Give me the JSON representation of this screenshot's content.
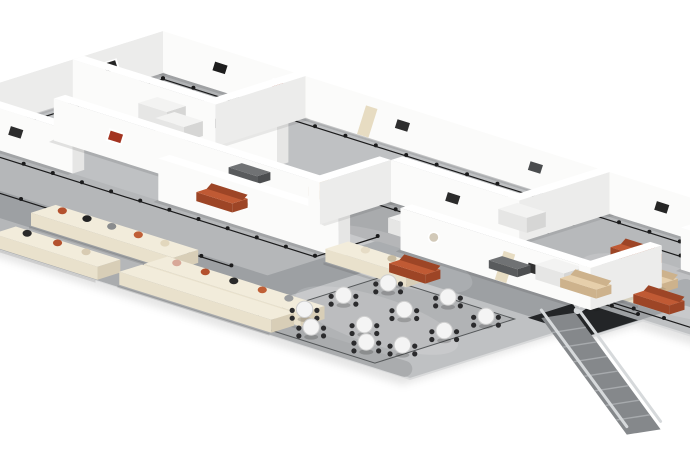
{
  "scene": {
    "description": "isometric-museum-floorplan-render",
    "width": 690,
    "height": 460
  },
  "projection": {
    "ox": 163,
    "oy": 73,
    "kx": 0.95,
    "ky": 0.3,
    "wall_height": 42,
    "wall_thickness": 12
  },
  "palette": {
    "background": "#ffffff",
    "floor_base": "#bfc1c3",
    "floor_edge": "#d9dadb",
    "shadow": "rgba(0,0,0,0.10)",
    "wall_front": "#fbfbfa",
    "wall_top": "#ffffff",
    "wall_side": "#ececeb",
    "wall_cap": "#e6e6e5",
    "track": "#1b1b1c",
    "path_dark": "#9da0a3",
    "edge_band": "#aaacae",
    "hole": "#232527",
    "escalator_rail": "#d6d9db",
    "escalator_band": "#85888b",
    "escalator_tread": "#a7aaad",
    "plinth_top": "#f2ecdb",
    "plinth_front": "#e9e1cc",
    "plinth_side": "#d8ceb7",
    "pedestal_top": "#f3f3f2",
    "pedestal_front": "#e6e6e5",
    "pedestal_side": "#d6d6d5",
    "bench_top": "#707274",
    "bench_front": "#595b5d",
    "sofa_terracotta_top": "#c05a34",
    "sofa_terracotta_front": "#9d4526",
    "sofa_beige_top": "#e6cfab",
    "sofa_beige_front": "#cdb28c",
    "table_top": "#f4f4f4",
    "table_rim": "#cfcfcf",
    "chair": "#2b2b2d",
    "door": "#e7dcc2",
    "art_frame": "#ffffff"
  },
  "floor": {
    "footprint": [
      [
        0,
        0
      ],
      [
        950,
        0
      ],
      [
        950,
        160
      ],
      [
        665,
        160
      ],
      [
        665,
        218
      ],
      [
        640,
        218
      ],
      [
        640,
        380
      ],
      [
        0,
        380
      ]
    ],
    "zones": [
      {
        "name": "gallery-a",
        "rect": [
          0,
          0,
          150,
          95
        ],
        "fill": "#b2b4b6"
      },
      {
        "name": "gallery-center-dark",
        "rect": [
          335,
          95,
          285,
          75
        ],
        "fill": "#a9abad"
      },
      {
        "name": "gallery-topright",
        "rect": [
          470,
          0,
          150,
          95
        ],
        "fill": "#b7b9bb"
      },
      {
        "name": "plinth-hall",
        "rect": [
          0,
          215,
          400,
          165
        ],
        "fill": "#b5b7b9"
      },
      {
        "name": "cafe-floor",
        "rect": [
          455,
          225,
          140,
          147
        ],
        "fill": "#b1b3b5"
      }
    ],
    "visitor_path": {
      "points": [
        [
          0,
          305
        ],
        [
          415,
          305
        ],
        [
          415,
          190
        ],
        [
          640,
          190
        ],
        [
          640,
          90
        ],
        [
          770,
          90
        ]
      ],
      "width": 26
    },
    "edge_band": {
      "points": [
        [
          150,
          366
        ],
        [
          620,
          366
        ]
      ],
      "width": 16
    }
  },
  "tracks": [
    {
      "points": [
        [
          12,
          12
        ],
        [
          940,
          12
        ]
      ]
    },
    {
      "points": [
        [
          12,
          12
        ],
        [
          12,
          368
        ]
      ]
    },
    {
      "points": [
        [
          12,
          82
        ],
        [
          136,
          82
        ]
      ]
    },
    {
      "points": [
        [
          26,
          158
        ],
        [
          322,
          158
        ]
      ]
    },
    {
      "points": [
        [
          322,
          158
        ],
        [
          322,
          108
        ],
        [
          600,
          108
        ],
        [
          600,
          155
        ],
        [
          655,
          155
        ]
      ]
    },
    {
      "points": [
        [
          20,
          228
        ],
        [
          388,
          228
        ],
        [
          388,
          162
        ]
      ]
    },
    {
      "points": [
        [
          12,
          288
        ],
        [
          360,
          288
        ]
      ]
    },
    {
      "points": [
        [
          930,
          35
        ],
        [
          548,
          35
        ],
        [
          548,
          148
        ],
        [
          930,
          148
        ]
      ]
    },
    {
      "points": [
        [
          470,
          12
        ],
        [
          470,
          92
        ]
      ]
    }
  ],
  "cafe": {
    "outline_rect": [
      455,
      225,
      140,
      147
    ],
    "tables": [
      [
        485,
        248
      ],
      [
        540,
        240
      ],
      [
        592,
        252
      ],
      [
        482,
        292
      ],
      [
        538,
        284
      ],
      [
        594,
        298
      ],
      [
        485,
        336
      ],
      [
        542,
        330
      ],
      [
        596,
        344
      ],
      [
        518,
        362
      ],
      [
        572,
        358
      ]
    ],
    "chair_offsets": [
      [
        13,
        0
      ],
      [
        -13,
        0
      ],
      [
        0,
        13
      ],
      [
        0,
        -13
      ]
    ]
  },
  "hole": [
    [
      600,
      162
    ],
    [
      662,
      162
    ],
    [
      662,
      216
    ],
    [
      600,
      216
    ]
  ],
  "escalator": {
    "from": [
      612,
      196
    ],
    "to": [
      748,
      242
    ],
    "width": 28,
    "drop": 62,
    "treads": 7,
    "approach": [
      [
        588,
        128
      ],
      [
        604,
        152
      ],
      [
        614,
        178
      ]
    ]
  },
  "walls": [
    {
      "axis": "u",
      "at": 0,
      "from": 0,
      "to": 950,
      "name": "perimeter-ne",
      "art": [
        {
          "u": 60,
          "c": "#1d1d1d"
        },
        {
          "u": 122,
          "c": "#b23a20",
          "framed": true
        },
        {
          "u": 252,
          "c": "#2e2e2e"
        },
        {
          "u": 392,
          "c": "#4a4c4e"
        },
        {
          "u": 525,
          "c": "#262626"
        },
        {
          "u": 615,
          "circle": "#cabfa9"
        },
        {
          "u": 762,
          "c": "#303032"
        },
        {
          "u": 885,
          "c": "#ad4a2c"
        }
      ],
      "doors": [
        215,
        705
      ]
    },
    {
      "axis": "v",
      "at": 0,
      "from": 0,
      "to": 380,
      "name": "perimeter-nw",
      "art": [
        {
          "v": 55,
          "c": "#242424",
          "framed": true
        },
        {
          "v": 250,
          "c": "#2a2a2a"
        }
      ],
      "doors": []
    },
    {
      "axis": "v",
      "at": 150,
      "from": 0,
      "to": 95,
      "name": "partition",
      "art": [],
      "doors": []
    },
    {
      "axis": "u",
      "at": 95,
      "from": 0,
      "to": 215,
      "name": "partition",
      "art": [
        {
          "u": 150,
          "c": "#333335"
        }
      ],
      "doors": []
    },
    {
      "axis": "u",
      "at": 170,
      "from": 55,
      "to": 335,
      "name": "partition",
      "art": [
        {
          "u": 120,
          "c": "#a33420",
          "framed": true
        },
        {
          "u": 250,
          "circle": "#cfc6b4"
        }
      ],
      "doors": []
    },
    {
      "axis": "v",
      "at": 335,
      "from": 95,
      "to": 170,
      "name": "partition",
      "art": [],
      "doors": []
    },
    {
      "axis": "u",
      "at": 95,
      "from": 335,
      "to": 470,
      "name": "partition",
      "art": [
        {
          "u": 400,
          "c": "#2b2b2b"
        }
      ],
      "doors": []
    },
    {
      "axis": "v",
      "at": 470,
      "from": 0,
      "to": 95,
      "name": "partition",
      "art": [],
      "doors": []
    },
    {
      "axis": "u",
      "at": 170,
      "from": 420,
      "to": 620,
      "name": "partition",
      "art": [
        {
          "u": 455,
          "circle": "#d2c9b8"
        },
        {
          "u": 560,
          "c": "#303030"
        }
      ],
      "doors": [
        530
      ]
    },
    {
      "axis": "v",
      "at": 620,
      "from": 95,
      "to": 170,
      "name": "partition",
      "art": [],
      "doors": []
    },
    {
      "axis": "v",
      "at": 700,
      "from": 0,
      "to": 58,
      "name": "partition",
      "art": [],
      "doors": []
    },
    {
      "axis": "u",
      "at": 215,
      "from": 0,
      "to": 120,
      "name": "hall-wall-west",
      "art": [
        {
          "u": 60,
          "c": "#2d2d2d"
        }
      ],
      "doors": []
    },
    {
      "axis": "u",
      "at": 215,
      "from": 210,
      "to": 400,
      "name": "hall-wall-east",
      "art": [
        {
          "u": 300,
          "circle": "#d6cdbd"
        }
      ],
      "doors": []
    },
    {
      "axis": "u",
      "at": 55,
      "from": 600,
      "to": 718,
      "name": "lounge-art-wall",
      "art": [
        {
          "u": 640,
          "c": "#323234"
        },
        {
          "u": 688,
          "c": "#ad4a2c"
        }
      ],
      "doors": []
    }
  ],
  "plinths": [
    {
      "u": 185,
      "v": 298,
      "w": 150,
      "d": 26,
      "items": [
        {
          "du": 20,
          "c": "#b4512e"
        },
        {
          "du": 46,
          "c": "#232323"
        },
        {
          "du": 72,
          "c": "#8a8c8e"
        },
        {
          "du": 100,
          "c": "#c05f36"
        },
        {
          "du": 128,
          "c": "#e2d7bd"
        }
      ]
    },
    {
      "u": 330,
      "v": 325,
      "w": 165,
      "d": 25,
      "items": [
        {
          "du": 22,
          "c": "#d8a898"
        },
        {
          "du": 52,
          "c": "#b4512e"
        },
        {
          "du": 82,
          "c": "#2a2a2a"
        },
        {
          "du": 112,
          "c": "#c05f36"
        },
        {
          "du": 140,
          "c": "#9a9c9e"
        }
      ]
    },
    {
      "u": 330,
      "v": 352,
      "w": 160,
      "d": 24,
      "items": []
    },
    {
      "u": 200,
      "v": 355,
      "w": 110,
      "d": 24,
      "items": [
        {
          "du": 24,
          "c": "#2a2a2a"
        },
        {
          "du": 56,
          "c": "#b4512e"
        },
        {
          "du": 86,
          "c": "#d8cbb2"
        }
      ]
    },
    {
      "u": 400,
      "v": 205,
      "w": 85,
      "d": 24,
      "items": [
        {
          "du": 30,
          "c": "#e6dcc6"
        },
        {
          "du": 58,
          "c": "#c9bda2"
        }
      ]
    },
    {
      "u": 568,
      "v": 112,
      "w": 70,
      "d": 24,
      "items": [
        {
          "du": 34,
          "c": "#1c1c1e"
        }
      ]
    }
  ],
  "pedestals": [
    [
      28,
      52
    ],
    [
      62,
      68
    ],
    [
      96,
      84
    ],
    [
      385,
      128
    ],
    [
      428,
      55
    ],
    [
      540,
      128
    ],
    [
      300,
      52
    ]
  ],
  "benches": [
    [
      205,
      122
    ],
    [
      497,
      140
    ]
  ],
  "sofas": [
    {
      "u": 560,
      "v": 62,
      "kind": "terracotta"
    },
    {
      "u": 610,
      "v": 95,
      "kind": "beige"
    },
    {
      "u": 655,
      "v": 60,
      "kind": "beige"
    },
    {
      "u": 650,
      "v": 128,
      "kind": "terracotta"
    },
    {
      "u": 700,
      "v": 98,
      "kind": "terracotta"
    },
    {
      "u": 585,
      "v": 140,
      "kind": "beige"
    },
    {
      "u": 470,
      "v": 205,
      "kind": "terracotta"
    },
    {
      "u": 250,
      "v": 188,
      "kind": "terracotta"
    },
    {
      "u": 300,
      "v": 120,
      "kind": "beige"
    }
  ],
  "highlights": [
    [
      430,
      190
    ],
    [
      620,
      95
    ],
    [
      525,
      300
    ]
  ]
}
